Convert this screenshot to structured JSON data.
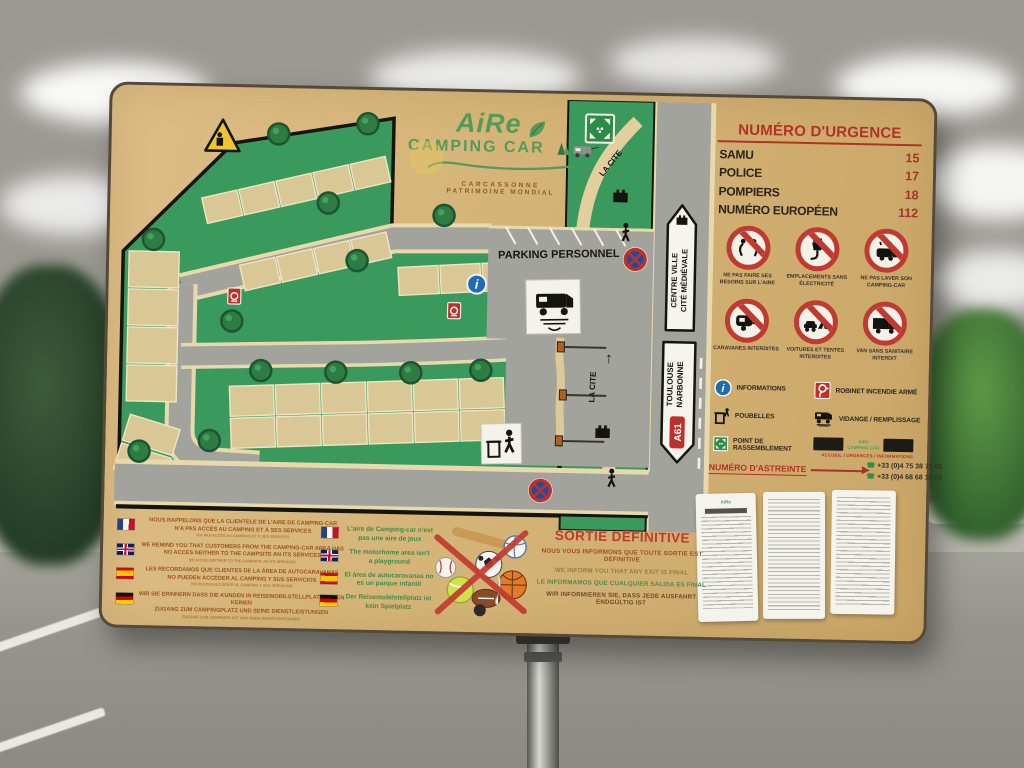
{
  "sign": {
    "logo": {
      "name": "AiRe",
      "tagline": "CAMPING CAR",
      "city": "CARCASSONNE",
      "subtitle": "PATRIMOINE MONDIAL"
    },
    "emergency": {
      "title": "NUMÉRO D'URGENCE",
      "items": [
        {
          "label": "SAMU",
          "number": "15"
        },
        {
          "label": "POLICE",
          "number": "17"
        },
        {
          "label": "POMPIERS",
          "number": "18"
        },
        {
          "label": "NUMÉRO EUROPÉEN",
          "number": "112"
        }
      ]
    },
    "prohibitions": [
      {
        "icon": "no-toilet-icon",
        "caption": "NE PAS FAIRE SES BESOINS SUR L'AIRE"
      },
      {
        "icon": "no-electricity-icon",
        "caption": "EMPLACEMENTS SANS ÉLECTRICITÉ"
      },
      {
        "icon": "no-washing-icon",
        "caption": "NE PAS LAVER SON CAMPING-CAR"
      },
      {
        "icon": "no-caravan-icon",
        "caption": "CARAVANES INTERDITES"
      },
      {
        "icon": "no-car-tent-icon",
        "caption": "VOITURES ET TENTES INTERDITES"
      },
      {
        "icon": "no-van-icon",
        "caption": "VAN SANS SANITAIRE INTERDIT"
      }
    ],
    "legend": {
      "col1": [
        {
          "icon": "info-icon",
          "label": "INFORMATIONS"
        },
        {
          "icon": "trash-icon",
          "label": "POUBELLES"
        },
        {
          "icon": "assembly-point-icon",
          "label": "POINT DE RASSEMBLEMENT"
        }
      ],
      "col2": [
        {
          "icon": "fire-hose-icon",
          "label": "ROBINET INCENDIE ARMÉ"
        },
        {
          "icon": "service-station-icon",
          "label": "VIDANGE / REMPLISSAGE"
        }
      ]
    },
    "astreinte": {
      "title": "NUMÉRO D'ASTREINTE",
      "phone1": "+33 (0)4 75 38 71 00",
      "phone2": "+33 (0)4 68 68 10 00",
      "fine_print": "ACCUEIL / URGENCES / INFORMATIONS"
    },
    "map": {
      "parking_personnel": "PARKING PERSONNEL",
      "la_cite": "LA CITE",
      "la_cite2": "LA CITE",
      "centre_ville_line1": "CENTRE VILLE",
      "centre_ville_line2": "CITÉ MÉDIÉVALE",
      "toulouse_line1": "TOULOUSE",
      "toulouse_line2": "NARBONNE",
      "a61": "A61"
    },
    "no_access_notice": {
      "blocks": [
        {
          "lang": "fr",
          "line1": "NOUS RAPPELONS QUE LA CLIENTÈLE DE L'AIRE DE CAMPING-CAR",
          "line2": "N'A PAS ACCÈS AU CAMPING ET À SES SERVICES"
        },
        {
          "lang": "en",
          "line1": "WE REMIND YOU THAT CUSTOMERS FROM THE CAMPING-CAR AREA HAS",
          "line2": "NO ACCES NEITHER TO THE CAMPSITE AN ITS SERVICES"
        },
        {
          "lang": "es",
          "line1": "LES RECORDAMOS QUE CLIENTES DE LA ÁREA DE AUTOCARAVANAS",
          "line2": "NO PUEDEN ACCEDER AL CAMPING Y SUS SERVICIOS"
        },
        {
          "lang": "de",
          "line1": "WIR SIE ERINNERN DASS DIE KUNDEN IN REISEMOBILSTELLPLATZ HABEN KEINEN",
          "line2": "ZUGANG ZUM CAMPINGPLATZ UND SEINE DIENSTLEISTUNGEN"
        }
      ]
    },
    "playground_notice": {
      "blocks": [
        {
          "lang": "fr",
          "line1": "L'aire de Camping-car n'est",
          "line2": "pas une aire de jeux"
        },
        {
          "lang": "en",
          "line1": "The motorhome area isn't",
          "line2": "a playground"
        },
        {
          "lang": "es",
          "line1": "El área de autocaravanas no",
          "line2": "es un parque infantil"
        },
        {
          "lang": "de",
          "line1": "Der Reisemobilstellplatz ist",
          "line2": "kein Spielplatz"
        }
      ]
    },
    "exit_notice": {
      "title": "SORTIE DÉFINITIVE",
      "lines": [
        "NOUS VOUS INFORMONS QUE TOUTE SORTIE EST DÉFINITIVE",
        "WE INFORM YOU THAT ANY EXIT IS FINAL",
        "LE INFORMAMOS QUE CUALQUIER SALIDA ES FINAL",
        "WIR INFORMIEREN SIE, DASS JEDE AUSFAHRT ENDGÜLTIG IST"
      ]
    }
  },
  "colors": {
    "sign_background": "#d5b478",
    "accent_red": "#b23226",
    "map_green": "#3a9a5e",
    "road_gray": "#a3a39d",
    "slot_beige": "#d9c795",
    "text_brown": "#9a531d",
    "text_green": "#3f8b49"
  }
}
